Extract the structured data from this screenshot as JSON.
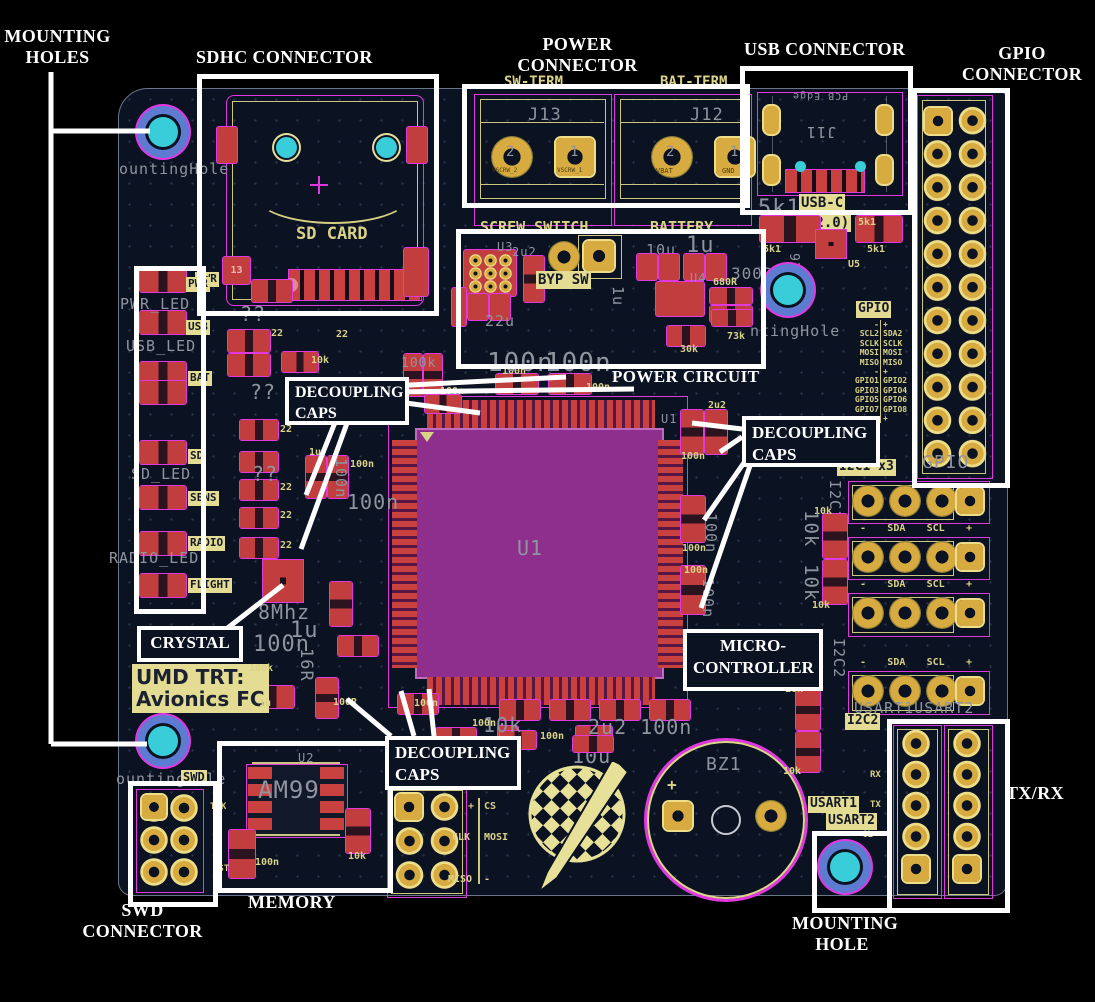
{
  "annotations": {
    "mounting_holes": [
      "MOUNTING",
      "HOLES"
    ],
    "sdhc": "SDHC CONNECTOR",
    "power": [
      "POWER",
      "CONNECTOR"
    ],
    "usb_conn": "USB CONNECTOR",
    "gpio_conn": [
      "GPIO",
      "CONNECTOR"
    ],
    "decoupling": [
      "DECOUPLING",
      "CAPS"
    ],
    "crystal": "CRYSTAL",
    "power_circuit": "POWER CIRCUIT",
    "micro": [
      "MICRO-",
      "CONTROLLER"
    ],
    "memory": "MEMORY",
    "swd": [
      "SWD",
      "CONNECTOR"
    ],
    "txrx": "TX/RX",
    "mounting_hole": [
      "MOUNTING",
      "HOLE"
    ]
  },
  "board": {
    "hole_top": "ountingHole",
    "hole_swd": "ountingHole",
    "hole_usb": "ntingHole"
  },
  "sdhc": {
    "sd_card": "SD CARD",
    "pad13": "13",
    "pwr": "PWR"
  },
  "power_conn": {
    "j13": "J13",
    "j12": "J12",
    "sw_term": "SW-TERM",
    "bat_term": "BAT-TERM",
    "screw_switch": "SCREW SWITCH",
    "battery": "BATTERY",
    "pin2": "2",
    "pin1": "1",
    "vscrw2": "VSCRW_2",
    "vscrw1": "VSCRW_1",
    "vbat": "VBAT",
    "gnd": "GND"
  },
  "usb": {
    "j11": "J11",
    "pcb_edge": "PCB Edge",
    "usbc": "USB-C",
    "v20": "(2.0)",
    "u5": "U5"
  },
  "gpio": {
    "label": "GPIO",
    "gray": "GPIO",
    "rows": [
      [
        "-",
        "+"
      ],
      [
        "SCL2",
        "SDA2"
      ],
      [
        "SCLK",
        "SCLK"
      ],
      [
        "MOSI",
        "MOSI"
      ],
      [
        "MISO",
        "MISO"
      ],
      [
        "-",
        "+"
      ],
      [
        "GPIO1",
        "GPIO2"
      ],
      [
        "GPIO3",
        "GPIO4"
      ],
      [
        "GPIO5",
        "GPIO6"
      ],
      [
        "GPIO7",
        "GPIO8"
      ],
      [
        "-",
        "+"
      ]
    ]
  },
  "leds": {
    "labels": [
      "PWR",
      "USB",
      "BAT",
      "SD",
      "SENS",
      "RADIO",
      "FLIGHT"
    ],
    "refs": [
      "PWR_LED",
      "USB_LED",
      "SD_LED",
      "RADIO_LED"
    ]
  },
  "power_ckt": {
    "u3": "U3",
    "u4": "U4",
    "byp": "BYP SW"
  },
  "mcu": {
    "ref": "U1",
    "ref2": "U1",
    "part": "STM32F7577"
  },
  "i2c": {
    "i2c1x3": "I2C1 x3",
    "i2c2": "I2C2",
    "minus": "-",
    "sda": "SDA",
    "scl": "SCL",
    "plus": "+",
    "i2c1_v": "I2C1",
    "i2c2_v": "I2C2"
  },
  "usart": {
    "u1": "USART1",
    "u2": "USART2",
    "gray": "USART1USART2",
    "rx": "RX",
    "tx": "TX",
    "clk": "CL"
  },
  "mem": {
    "u2": "U2",
    "mark": "AM99",
    "tck": "TCK",
    "rst": "RST"
  },
  "swd": {
    "label": "SWD"
  },
  "spi": {
    "label": "SPI",
    "plus": "+",
    "cs": "CS",
    "clk": "CLK",
    "mosi": "MOSI",
    "miso": "MISO",
    "minus": "-"
  },
  "buzzer": {
    "ref": "BZ1",
    "plus": "+"
  },
  "brand": {
    "l1": "UMD TRT:",
    "l2": "Avionics FC"
  },
  "scatter": [
    "10k",
    "100n",
    "100n",
    "100n",
    "1u",
    "100n",
    "2u2",
    "100n",
    "100n",
    "100n",
    "10k",
    "10k",
    "22",
    "22",
    "22",
    "22",
    "22",
    "100k",
    "1u",
    "100R",
    "100n",
    "10k",
    "100n",
    "100n",
    "10k",
    "10k",
    "10k",
    "30k",
    "73k",
    "680R",
    "5k1",
    "5k1",
    "5k1",
    "100n",
    "??",
    "??",
    "??",
    "100n",
    "100n",
    "100k",
    "1u",
    "100n",
    "8Mhz",
    "16R",
    "100n",
    "100n",
    "10u",
    "1u",
    "22u",
    "2u2",
    "300R",
    "1u",
    "5k1",
    "USB C6",
    "2u2 100n",
    "10k",
    "100n",
    "10k",
    "10k",
    "10u",
    "100n",
    "22"
  ]
}
